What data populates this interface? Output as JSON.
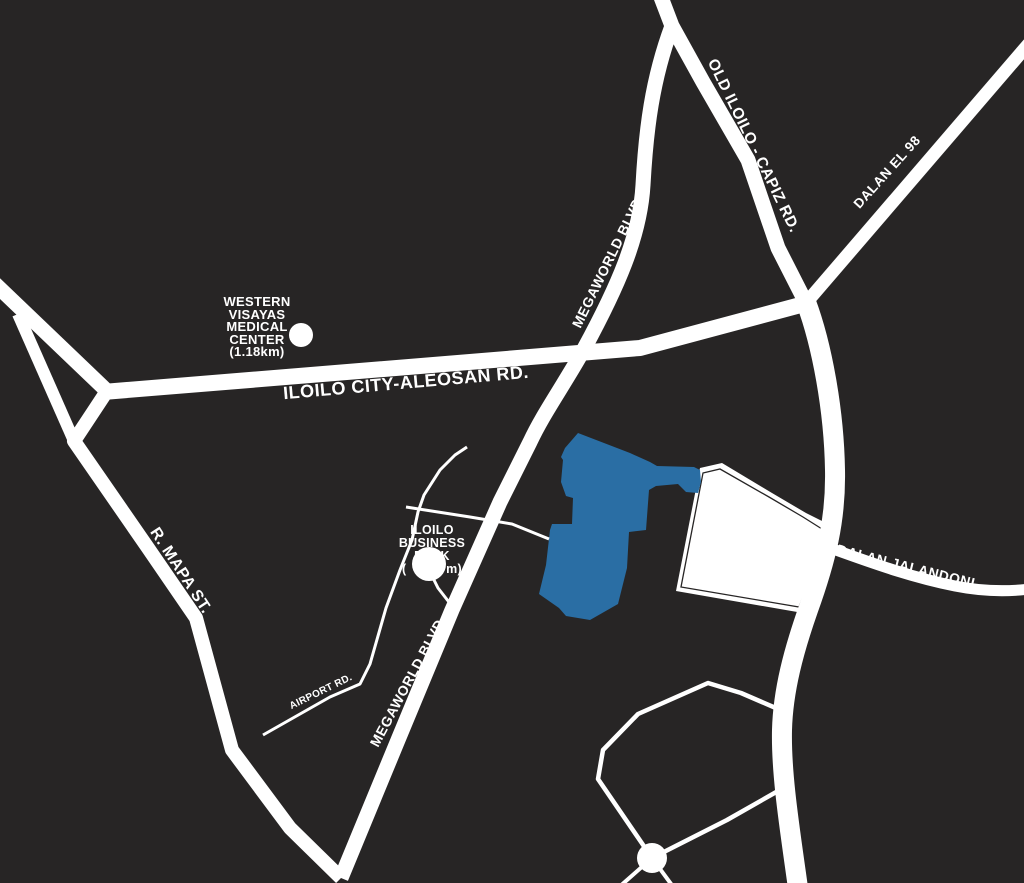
{
  "map": {
    "colors": {
      "background": "#272525",
      "road": "#ffffff",
      "site": "#2a6ea4"
    },
    "road_labels": {
      "old_iloilo_capiz": "OLD ILOILO - CAPIZ RD.",
      "dalan_el_98": "DALAN EL 98",
      "megaworld_blvd_north": "MEGAWORLD BLVD.",
      "iloilo_city_aleosan": "ILOILO CITY-ALEOSAN RD.",
      "r_mapa": "R. MAPA ST.",
      "megaworld_blvd_south": "MEGAWORLD BLVD.",
      "airport_rd": "AIRPORT RD.",
      "dalan_jalandoni": "DALAN JALANDONI"
    },
    "landmarks": {
      "medical_center": {
        "lines": [
          "WESTERN",
          "VISAYAS",
          "MEDICAL",
          "CENTER",
          "(1.18km)"
        ]
      },
      "business_park": {
        "lines": [
          "ILOILO",
          "BUSINESS",
          "PARK"
        ],
        "distance_prefix": "(",
        "distance_suffix": "m)"
      }
    }
  }
}
